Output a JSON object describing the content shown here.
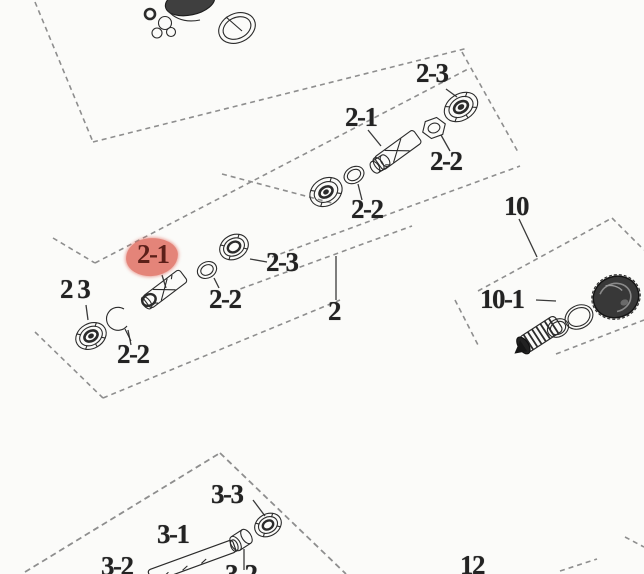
{
  "diagram": {
    "type": "exploded-parts-diagram",
    "background_color": "#fbfbf9",
    "line_color": "#2b2b2b",
    "dashed_box_color": "#8e8e8e",
    "highlight": {
      "label": "2-1",
      "fill_color": "#e06a5e",
      "text_color": "#5c1f19"
    },
    "labels": [
      {
        "id": "callout-2-3-topright",
        "text": "2-3"
      },
      {
        "id": "callout-2-1-topright",
        "text": "2-1"
      },
      {
        "id": "callout-2-2-topright",
        "text": "2-2"
      },
      {
        "id": "callout-2-2-middle",
        "text": "2-2"
      },
      {
        "id": "callout-2-3-middle",
        "text": "2-3"
      },
      {
        "id": "callout-2",
        "text": "2"
      },
      {
        "id": "callout-2-1-highlighted",
        "text": "2-1"
      },
      {
        "id": "callout-2-3-left",
        "text": "2 3"
      },
      {
        "id": "callout-2-2-left-lower",
        "text": "2-2"
      },
      {
        "id": "callout-2-2-left-right",
        "text": "2-2"
      },
      {
        "id": "callout-10",
        "text": "10"
      },
      {
        "id": "callout-10-1",
        "text": "10-1"
      },
      {
        "id": "callout-3-3",
        "text": "3-3"
      },
      {
        "id": "callout-3-1",
        "text": "3-1"
      },
      {
        "id": "callout-3-2",
        "text": "3-2"
      },
      {
        "id": "callout-3-2-clipped",
        "text": "3-2"
      },
      {
        "id": "callout-12",
        "text": "12"
      }
    ],
    "parts": [
      "ball-bearing",
      "snap-ring",
      "spacer-ring",
      "shaft-sleeve",
      "hex-nut",
      "coiled-spring-cap",
      "cv-boot-shaft",
      "bushing",
      "shaft-rod"
    ]
  }
}
